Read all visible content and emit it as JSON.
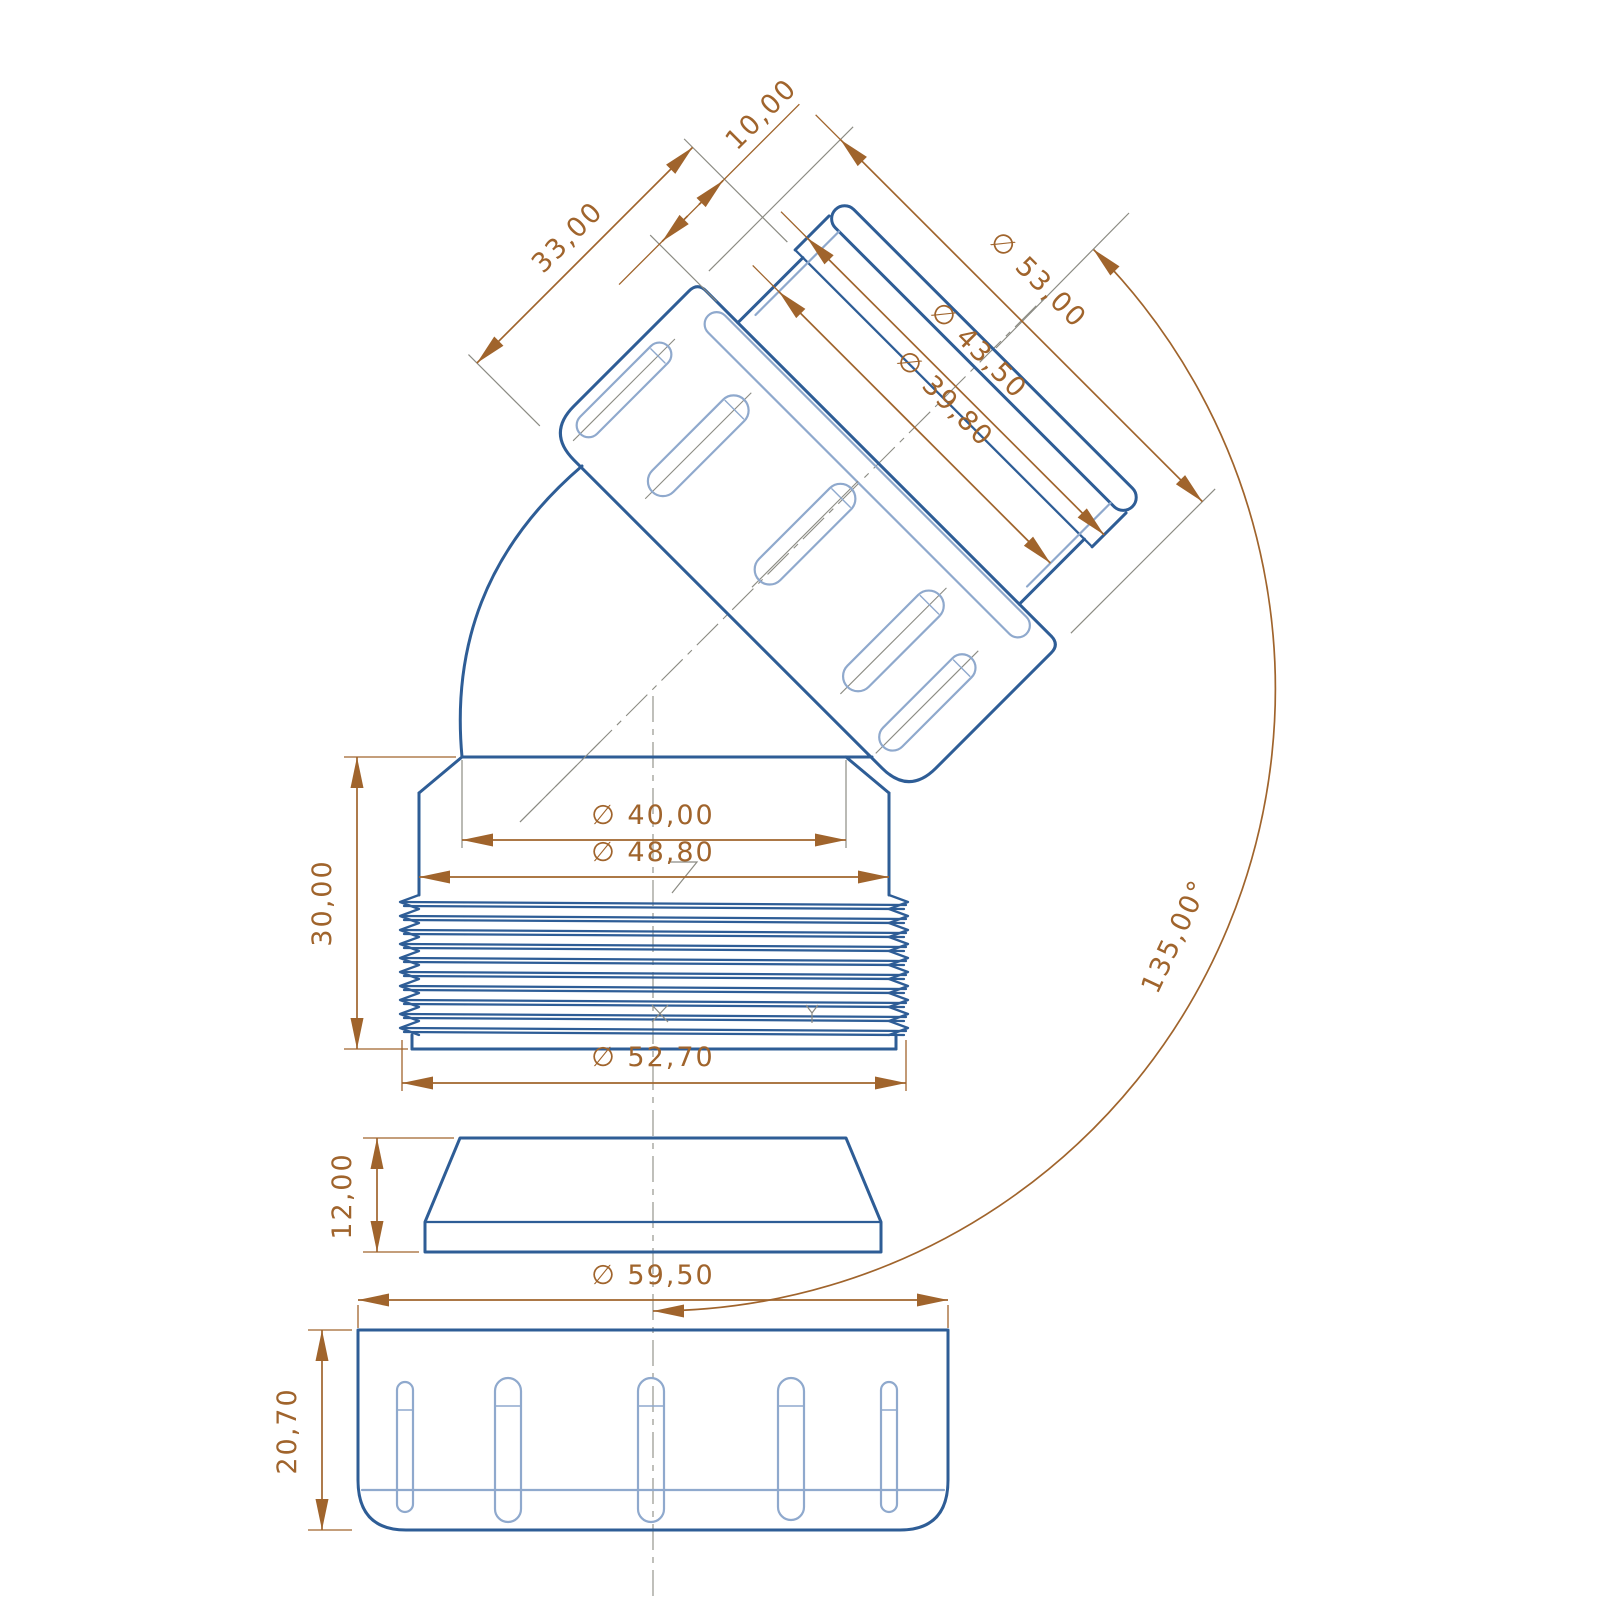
{
  "drawing": {
    "type": "technical-dimension-drawing",
    "part": "135-degree pipe elbow connector with swivel nut, gasket and locking cap",
    "views": [
      "tilted-outlet-nut",
      "threaded-body",
      "gasket",
      "locking-cap"
    ]
  },
  "labels": {
    "len33": "33,00",
    "len10": "10,00",
    "dia53": "∅ 53,00",
    "dia435": "∅ 43,50",
    "dia398": "∅ 39,80",
    "dia40": "∅ 40,00",
    "dia488": "∅ 48,80",
    "len30": "30,00",
    "dia527": "∅ 52,70",
    "len12": "12,00",
    "dia595": "∅ 59,50",
    "len207": "20,70",
    "angle135": "135,00°"
  },
  "colors": {
    "outline": "#2e5d96",
    "outline_light": "#8fa9cd",
    "dimension": "#a0642c",
    "extension": "#8b8b83",
    "background": "#ffffff"
  }
}
